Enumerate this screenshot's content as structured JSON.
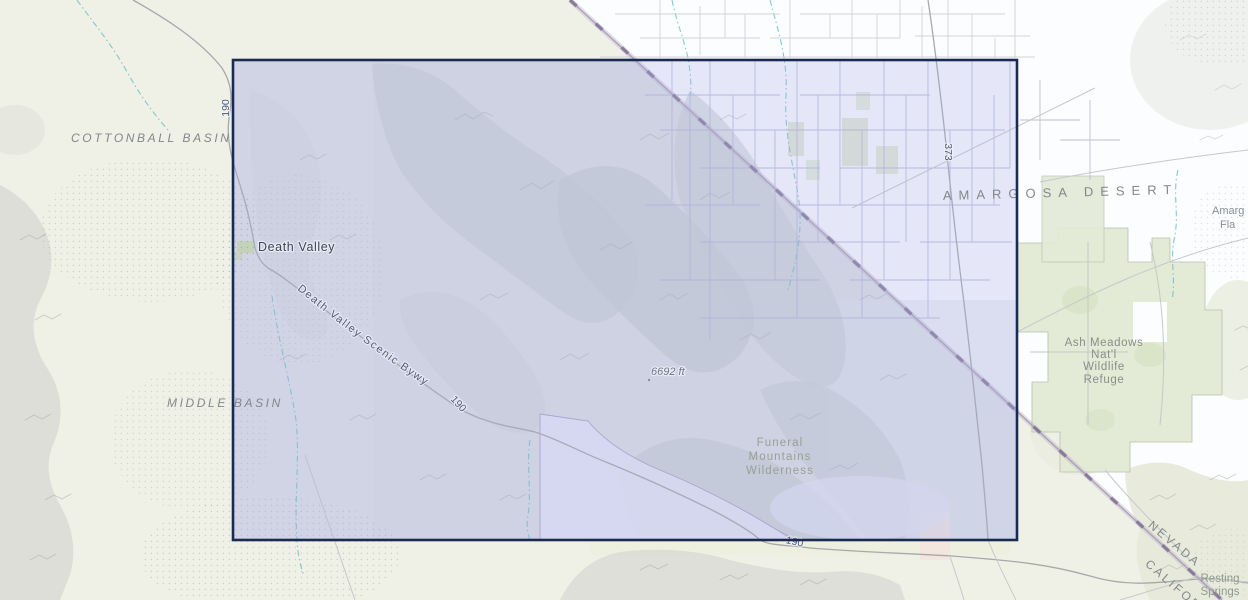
{
  "colors": {
    "land-cream": "#eff1e6",
    "land-white": "#fcfdff",
    "terrain-gray": "#ccd1d3",
    "terrain-soft": "#dde0e2",
    "hills-green": "#e6e9d8",
    "refuge-green": "#e3ead6",
    "patch-green": "#dde6cb",
    "settlement-green": "#cfe0ab",
    "water-teal": "#6fc0c4",
    "road-gray": "#a7a9ab",
    "road-faint": "#c6c8ca",
    "grid-white-area": "#cbced3",
    "grid-purple": "#b2b4d6",
    "state-band": "#c9bccf",
    "state-dash": "#7c6f93",
    "selection-fill": "rgba(167,172,228,0.27)",
    "selection-border": "#1b2a50",
    "label-gray": "#83878b",
    "label-dark": "#39455a",
    "label-road": "#4f5a7d",
    "label-elev": "#6d7590",
    "label-green": "#97a095",
    "stipple": "#7f858d"
  },
  "selection": {
    "x": 233,
    "y": 60,
    "w": 784,
    "h": 480
  },
  "map": {
    "labels": {
      "cottonball_basin": "COTTONBALL BASIN",
      "middle_basin": "MIDDLE BASIN",
      "death_valley_town": "Death Valley",
      "scenic_byway": "Death Valley Scenic Bywy",
      "route_190": "190",
      "route_373": "373",
      "elevation_marker": "6692 ft",
      "amargosa_desert": "AMARGOSA DESERT",
      "funeral_wilderness_lines": [
        "Funeral",
        "Mountains",
        "Wilderness"
      ],
      "ash_meadows_lines": [
        "Ash Meadows",
        "Nat'l",
        "Wildlife",
        "Refuge"
      ],
      "state_nevada": "NEVADA",
      "state_california": "CALIFOR",
      "resting_springs_lines": [
        "Resting",
        "Springs"
      ],
      "amargosa_flat_lines": [
        "Amarg",
        "Fla"
      ]
    }
  }
}
